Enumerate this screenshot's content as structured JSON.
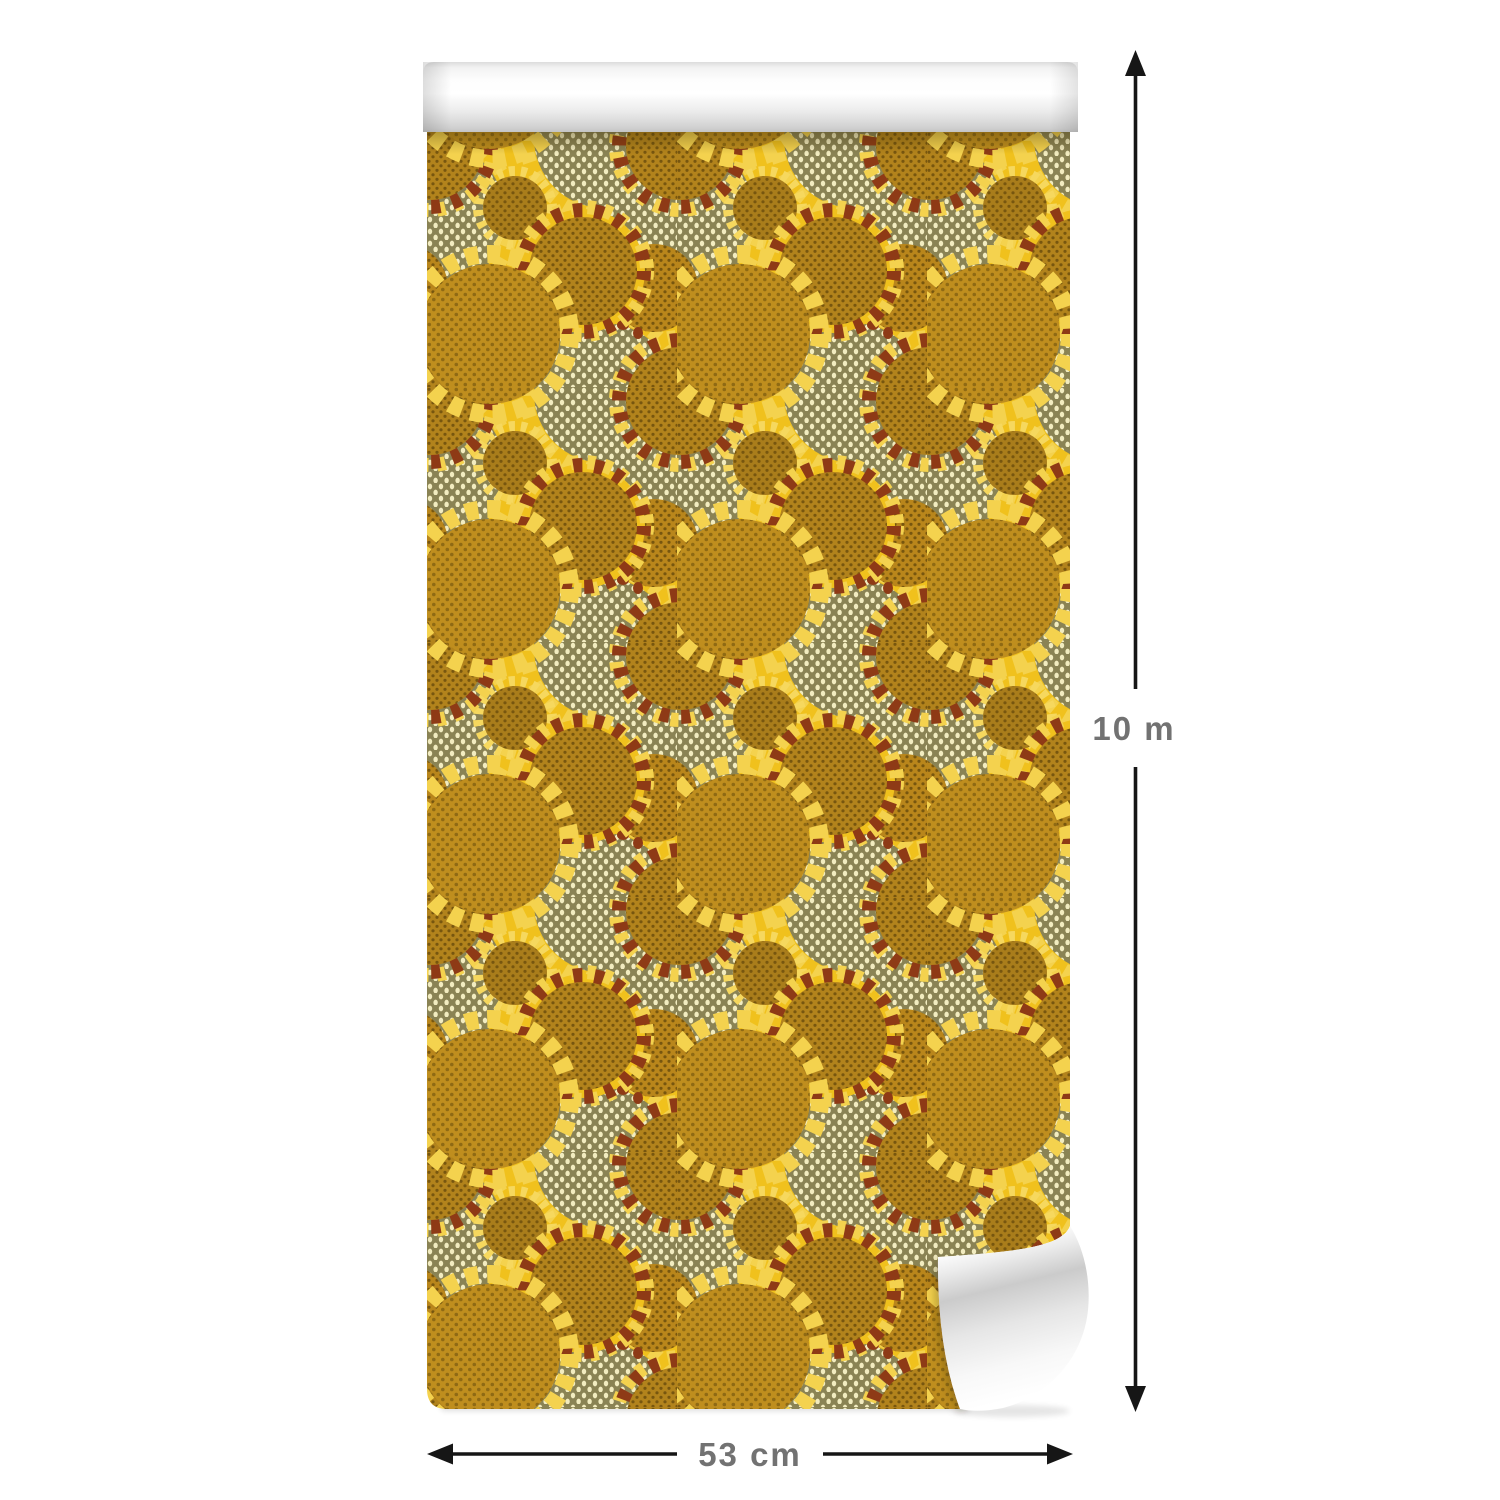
{
  "product": {
    "kind": "wallpaper-roll",
    "pattern": "sunflower-circles"
  },
  "dimensions": {
    "height_label": "10 m",
    "width_label": "53 cm"
  },
  "colors": {
    "page_background": "#ffffff",
    "pattern_background": "#F0C11D",
    "pale_petal": "#F4D24E",
    "fringe_yellow": "#F6D85E",
    "olive_disc": "#8A8354",
    "cream_dot": "#F2ECC0",
    "mustard_disc": "#B2831C",
    "dark_dot": "#77560F",
    "large_mustard_disc": "#BF8E1E",
    "mid_dot": "#8F6A14",
    "red_petal": "#8E3A16",
    "roll_paper_back": "#f5f5f5",
    "arrow": "#161616",
    "label_text": "#727272"
  }
}
